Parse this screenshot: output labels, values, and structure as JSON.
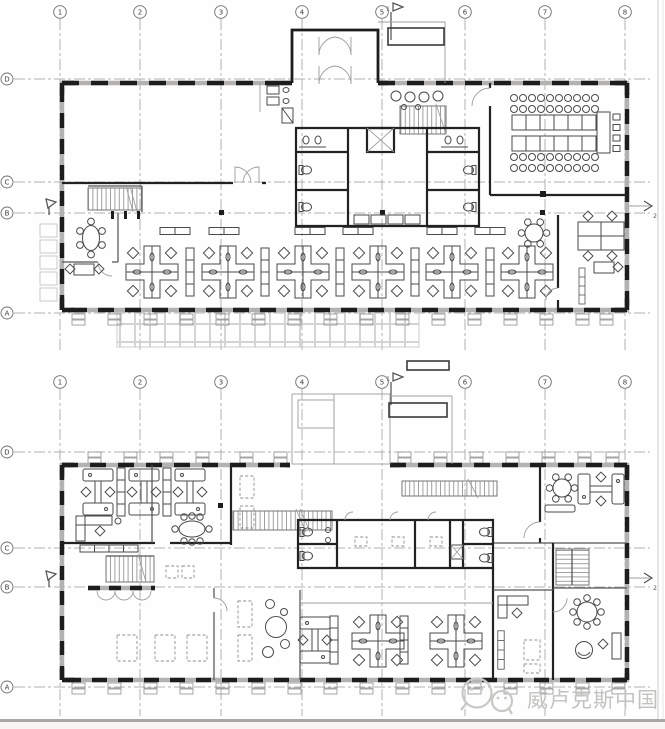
{
  "axes": {
    "cols": [
      "1",
      "2",
      "3",
      "4",
      "5",
      "6",
      "7",
      "8"
    ],
    "rows": [
      "D",
      "C",
      "B",
      "A"
    ]
  },
  "section_markers": {
    "flag": "1",
    "arrow": "2"
  },
  "watermark": {
    "icon": "wechat-icon",
    "text": "威卢克斯中国",
    "color": "#c3c2bf"
  },
  "colors": {
    "wall": "#1d1d1d",
    "window_band": "#b3b2b0",
    "grid_line": "#9b9b9b",
    "furniture": "#4b4b4b",
    "watermark": "#c3c2bf",
    "page_edge": "#a9a7a4"
  }
}
